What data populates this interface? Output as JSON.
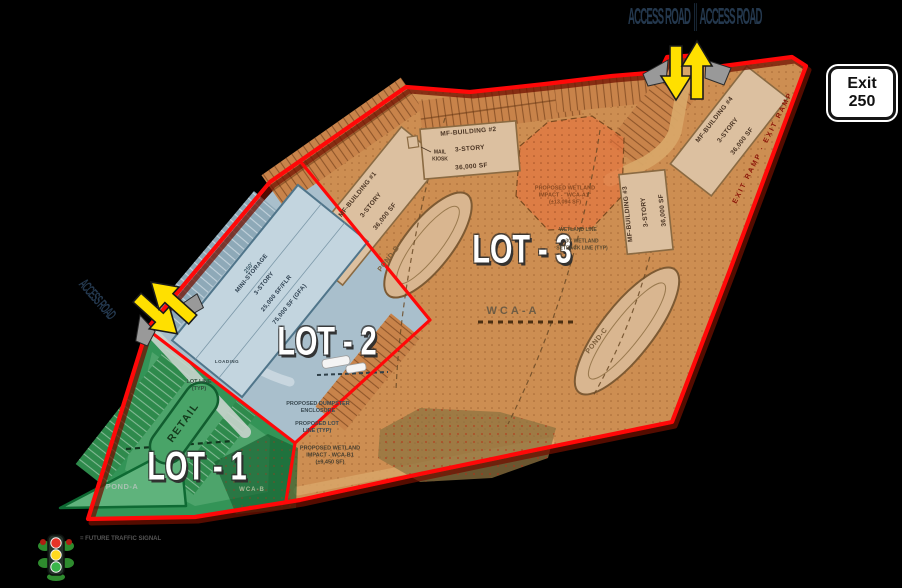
{
  "lots": {
    "lot1": {
      "label": "LOT - 1",
      "color": "#2e9152"
    },
    "lot2": {
      "label": "LOT - 2",
      "color": "#a9bfcc"
    },
    "lot3": {
      "label": "LOT - 3",
      "color": "#cd8e52"
    }
  },
  "buildings": {
    "mf1": {
      "name": "MF-BUILDING #1",
      "story": "3-STORY",
      "area": "36,000 SF"
    },
    "mf2": {
      "name": "MF-BUILDING #2",
      "story": "3-STORY",
      "area": "36,000 SF"
    },
    "mf3": {
      "name": "MF-BUILDING #3",
      "story": "3-STORY",
      "area": "36,000 SF"
    },
    "mf4": {
      "name": "MF-BUILDING #4",
      "story": "3-STORY",
      "area": "36,000 SF"
    },
    "storage": {
      "name": "MINI-STORAGE",
      "story": "3-STORY",
      "floor_area": "25,000 SF/FLR",
      "gross_area": "75,000 SF (GFA)"
    },
    "retail": {
      "name": "RETAIL"
    }
  },
  "ponds": {
    "a": "POND-A",
    "b": "POND-B",
    "c": "POND-C"
  },
  "wetlands": {
    "wca_a": "WCA-A",
    "wca_b": "WCA-B",
    "impact_a": "PROPOSED WETLAND\nIMPACT - \"WCA-A1\"\n(±13,094 SF)",
    "impact_b": "PROPOSED WETLAND\nIMPACT - WCA-B1\n(±9,450 SF)",
    "line": "WETLAND LINE",
    "setback": "30' WETLAND\nSETBACK LINE (TYP)"
  },
  "annotations": {
    "mail_kiosk": "MAIL\nKIOSK",
    "loading": "LOADING",
    "lot_line": "LOT LINE\n(TYP)",
    "proposed_lot_line": "PROPOSED LOT\nLINE (TYP)",
    "dumpster": "PROPOSED DUMPSTER\nENCLOSURE",
    "dim_250": "250'"
  },
  "roads": {
    "top_label": "ACCESS ROAD ║ ACCESS ROAD",
    "left_label": "ACCESS ROAD",
    "ramp_label": "EXIT RAMP · EXIT RAMP"
  },
  "signs": {
    "exit": {
      "line1": "Exit",
      "line2": "250"
    }
  },
  "legend": {
    "signal": "= FUTURE TRAFFIC SIGNAL"
  },
  "colors": {
    "boundary": "#ff0808",
    "lot1": "#2e9152",
    "lot2": "#a9bfcc",
    "lot3": "#cd8e52",
    "arrow": "#ffe000",
    "wetland": "#e8713d"
  }
}
